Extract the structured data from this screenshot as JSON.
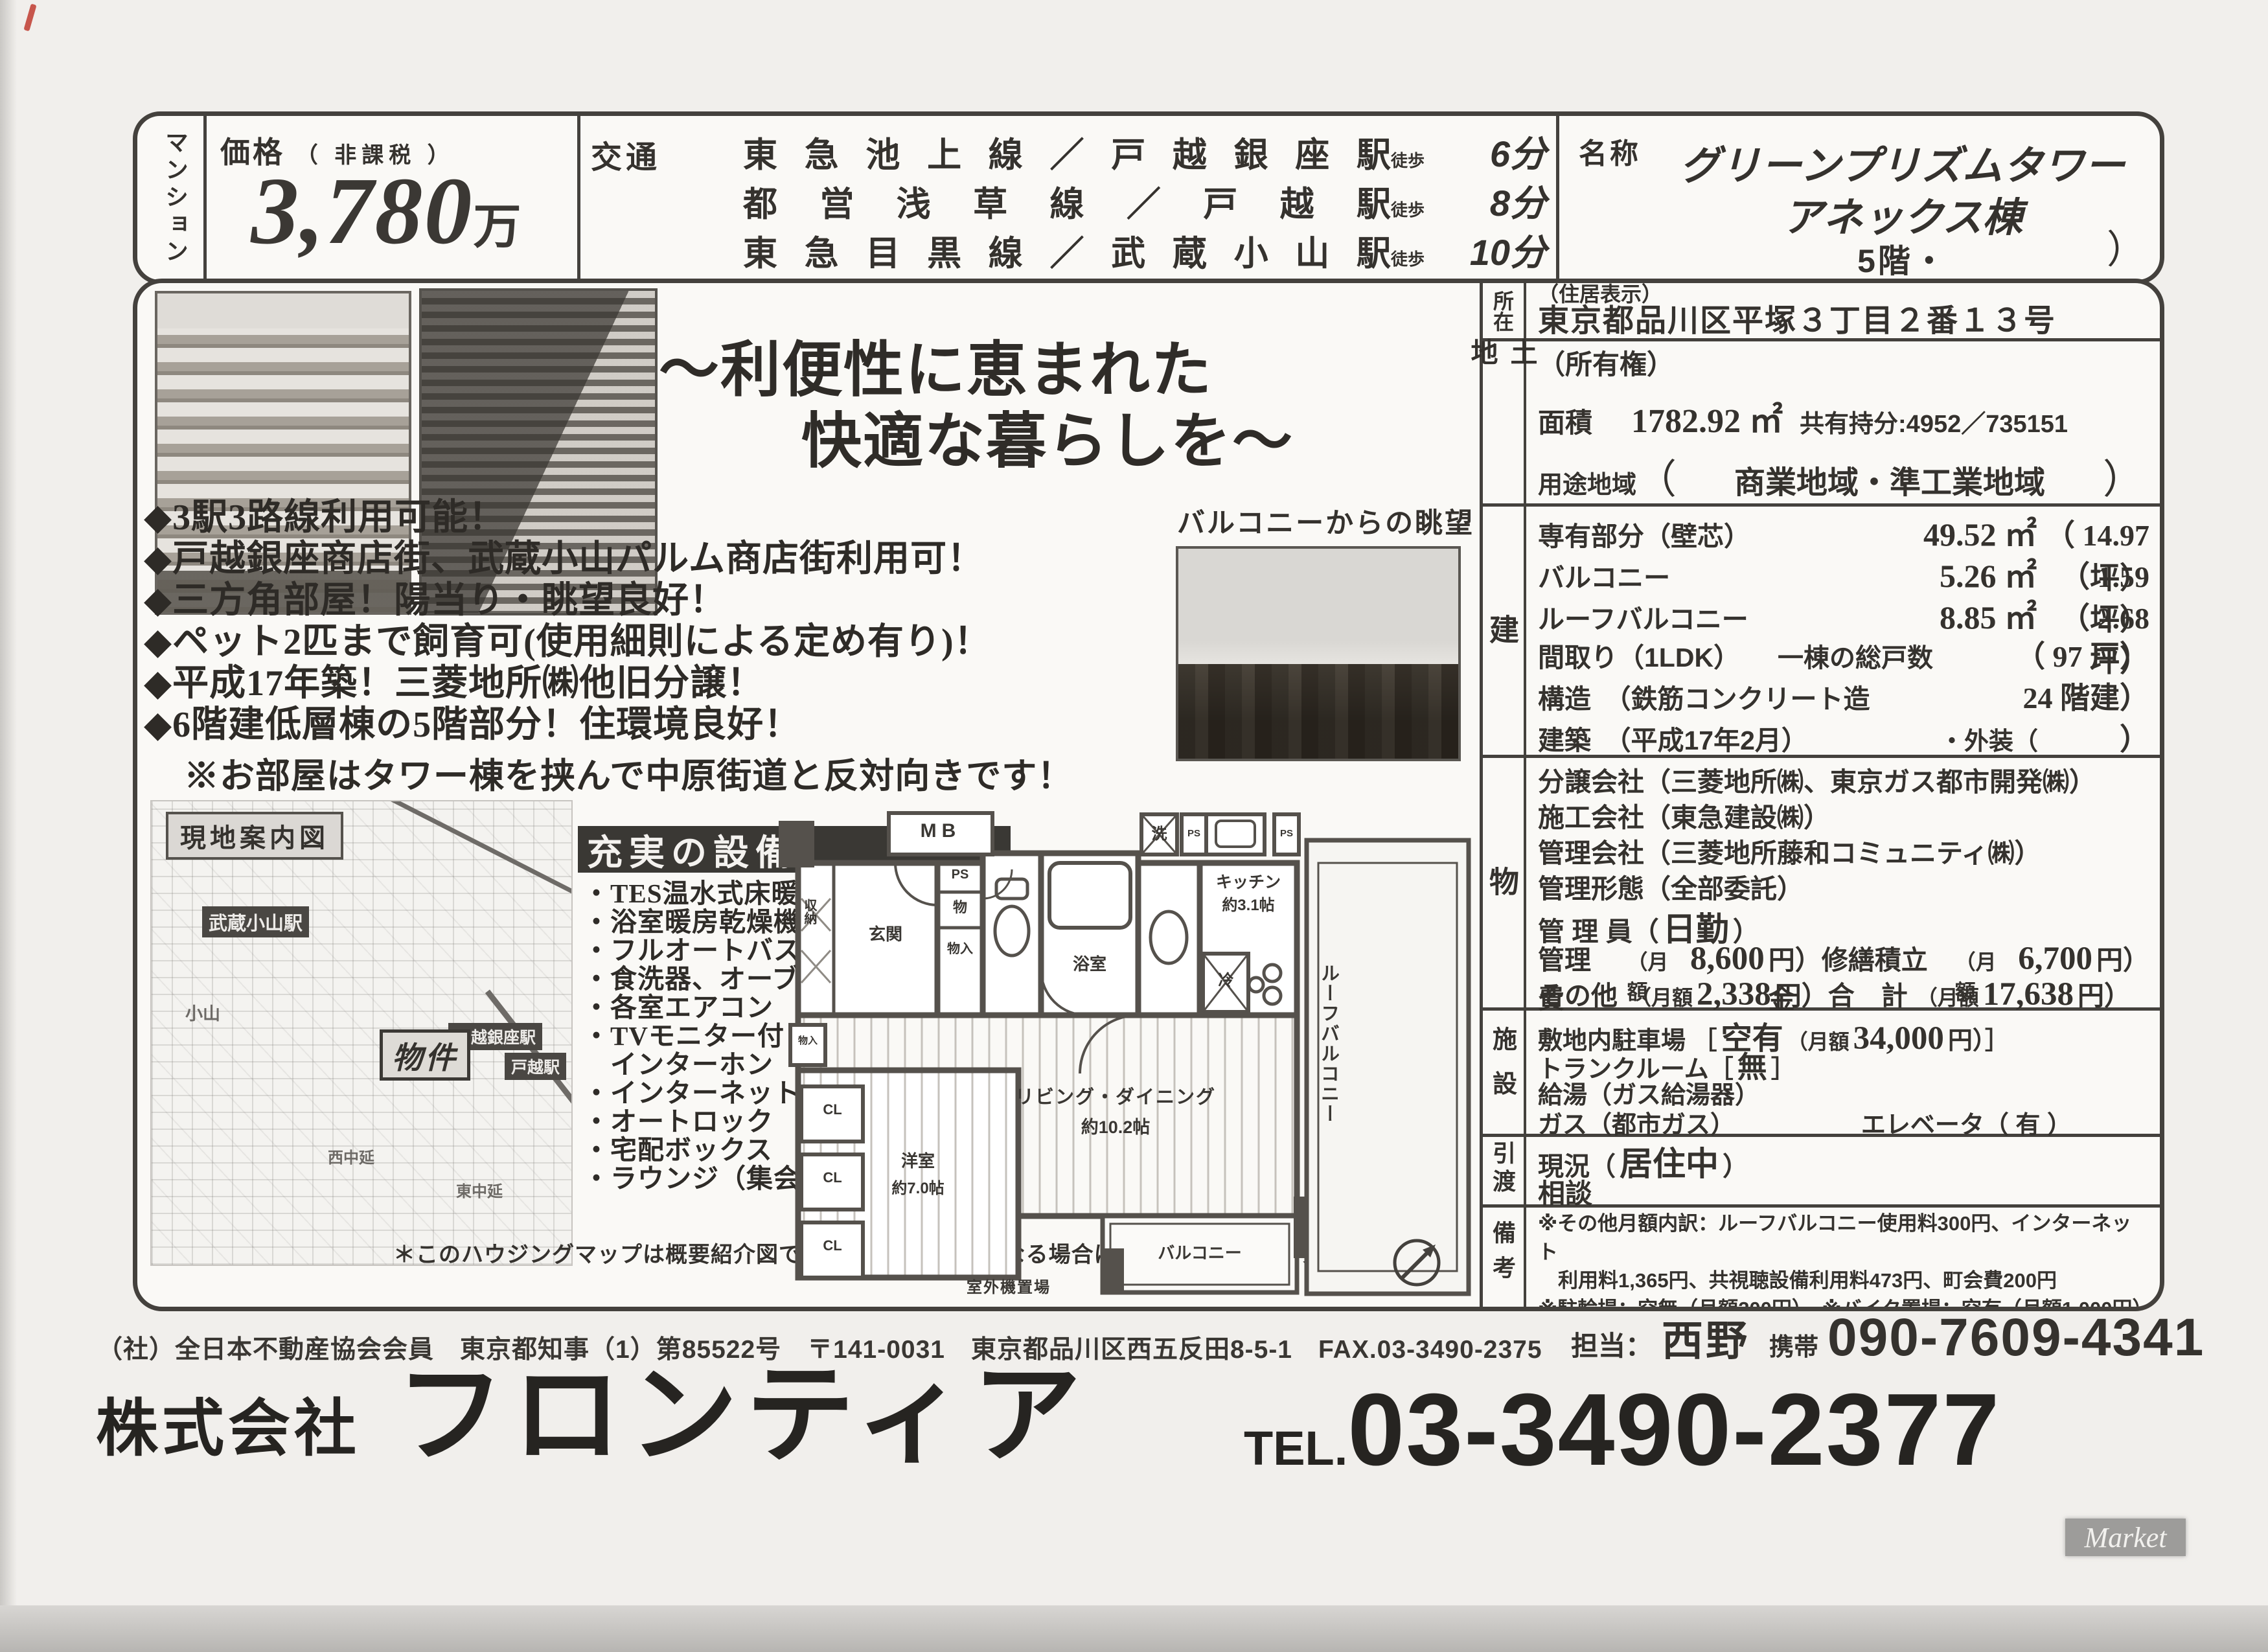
{
  "header": {
    "type_vertical": "マンション",
    "price_label": "価格",
    "price_tax": "（ 非課税 ）",
    "price_value": "3,780",
    "price_unit": "万円",
    "access_label": "交通",
    "access": [
      {
        "route": "東急池上線／戸越銀座駅",
        "walk": "徒歩",
        "min": "6分"
      },
      {
        "route": "都営浅草線／戸越駅",
        "walk": "徒歩",
        "min": "8分"
      },
      {
        "route": "東急目黒線／武蔵小山駅",
        "walk": "徒歩",
        "min": "10分"
      }
    ],
    "name_label": "名称",
    "name_line1": "グリーンプリズムタワー",
    "name_line2": "アネックス棟",
    "name_floor": "5階・",
    "name_paren": "）"
  },
  "catch": {
    "line1": "～利便性に恵まれた",
    "line2": "快適な暮らしを～"
  },
  "bullets": [
    "◆3駅3路線利用可能！",
    "◆戸越銀座商店街、武蔵小山パルム商店街利用可！",
    "◆三方角部屋！陽当り・眺望良好！",
    "◆ペット2匹まで飼育可(使用細則による定め有り)！",
    "◆平成17年築！三菱地所㈱他旧分譲！",
    "◆6階建低層棟の5階部分！住環境良好！"
  ],
  "bullets_note": "※お部屋はタワー棟を挟んで中原街道と反対向きです！",
  "view_label": "バルコニーからの眺望",
  "map": {
    "title": "現地案内図",
    "musashikoyama": "武蔵小山駅",
    "togoshiginza": "戸越銀座駅",
    "togoshi": "戸越駅",
    "bukken": "物件",
    "koyama": "小山",
    "nishinakanobu": "西中延",
    "higashinakanobu": "東中延",
    "note": "＊このハウジングマップは概要紹介図です。図面と現況が異なる場合は現況優先となります。"
  },
  "equipment": {
    "title": "充実の設備",
    "items": [
      "・TES温水式床暖房",
      "・浴室暖房乾燥機",
      "・フルオートバス",
      "・食洗器、オーブン",
      "・各室エアコン",
      "・TVモニター付",
      "　インターホン",
      "・インターネット",
      "・オートロック",
      "・宅配ボックス",
      "・ラウンジ（集会室）"
    ]
  },
  "floorplan": {
    "mb": "MB",
    "ps": "PS",
    "mono": "物",
    "monoire": "物入",
    "shunou": "収納",
    "genkan": "玄関",
    "bath": "浴室",
    "washer": "洗",
    "fridge": "冷",
    "kitchen": "キッチン",
    "kitchen_size": "約3.1帖",
    "living": "リビング・ダイニング",
    "living_size": "約10.2帖",
    "bedroom": "洋室",
    "bedroom_size": "約7.0帖",
    "cl": "CL",
    "balcony": "バルコニー",
    "roof_balcony": "ルーフバルコニー",
    "outdoor": "室外機置場"
  },
  "table": {
    "shozai_label": "所在",
    "tochi_label": "土地",
    "tatemono_label": "建",
    "bukken_label": "物",
    "shisetsu_label": "施設",
    "hikiwatashi_label": "引渡",
    "biko_label": "備考",
    "shozai": {
      "jukyo": "（住居表示）",
      "address": "東京都品川区平塚３丁目２番１３号"
    },
    "tochi": {
      "ownership": "（所有権）",
      "area_label": "面積",
      "area": "1782.92 ㎡",
      "share": "共有持分:4952／735151",
      "zone_label": "用途地域",
      "zone_open": "（",
      "zone": "商業地域・準工業地域",
      "zone_close": "）"
    },
    "build": {
      "senyu_label": "専有部分（壁芯）",
      "senyu_m2": "49.52 ㎡",
      "senyu_tsubo": "（ 14.97 坪）",
      "balcony_label": "バルコニー",
      "balcony_m2": "5.26 ㎡",
      "balcony_tsubo": "（ 1.59 坪）",
      "roof_label": "ルーフバルコニー",
      "roof_m2": "8.85 ㎡",
      "roof_tsubo": "（ 2.68 坪）",
      "madori_label": "間取り（1LDK）",
      "units_label": "一棟の総戸数",
      "units": "（ 97 戸）",
      "kozo_label": "構造　（鉄筋コンクリート造",
      "kozo_floors": "24 階建）",
      "built_label": "建築　（平成17年2月）",
      "gaiso_label": "・外装（",
      "gaiso_close": "）"
    },
    "mono": {
      "l1": "分譲会社（三菱地所㈱、東京ガス都市開発㈱）",
      "l2": "施工会社（東急建設㈱）",
      "l3": "管理会社（三菱地所藤和コミュニティ㈱）",
      "l4": "管理形態（全部委託）",
      "kanrinin_a": "管 理 員（",
      "kanrinin_b": "日勤",
      "kanrinin_c": "）",
      "kanrihi_a": "管理費",
      "kanrihi_b": "（月額",
      "kanrihi_n1": "8,600",
      "kanrihi_c": "円）修繕積立金",
      "kanrihi_d": "（月額",
      "kanrihi_n2": "6,700",
      "kanrihi_e": "円）",
      "sonota_a": "その他",
      "sonota_b": "（月額",
      "sonota_n1": "2,338",
      "sonota_c": "円）合　計",
      "sonota_d": "（月額",
      "sonota_n2": "17,638",
      "sonota_e": "円）"
    },
    "shisetsu": {
      "parking_a": "敷地内駐車場 ［",
      "parking_b": "空有",
      "parking_c": "（月額",
      "parking_n": "34,000",
      "parking_d": "円）］",
      "trunk_a": "トランクルーム［",
      "trunk_b": "無",
      "trunk_c": "］",
      "kyuto": "給湯（ガス給湯器）",
      "gas": "ガス（都市ガス）",
      "elevator": "エレベータ（ 有 ）"
    },
    "hikiwatashi": {
      "genkyo_a": "現況（",
      "genkyo_b": "居住中",
      "genkyo_c": "）",
      "soudan": "相談"
    },
    "biko": [
      "※その他月額内訳：ルーフバルコニー使用料300円、インターネット",
      "　利用料1,365円、共視聴設備利用料473円、町会費200円",
      "※駐輪場：空無（月額200円）　※バイク置場：空有（月額1,000円）"
    ]
  },
  "footer": {
    "registration": "（社）全日本不動産協会会員　東京都知事（1）第85522号　〒141-0031　東京都品川区西五反田8-5-1　FAX.03-3490-2375",
    "tantou_label": "担当：",
    "tantou_name": "西野",
    "keitai_label": "携帯",
    "keitai_number": "090-7609-4341",
    "company_prefix": "株式会社",
    "company_name": "フロンティア",
    "tel_label": "TEL.",
    "tel_number": "03-3490-2377",
    "stamp": "Market"
  },
  "colors": {
    "border_dark": "#44413d",
    "black_box": "#3a3834",
    "stamp_gray": "#9d9c9a",
    "red_mark": "#c03b30"
  }
}
